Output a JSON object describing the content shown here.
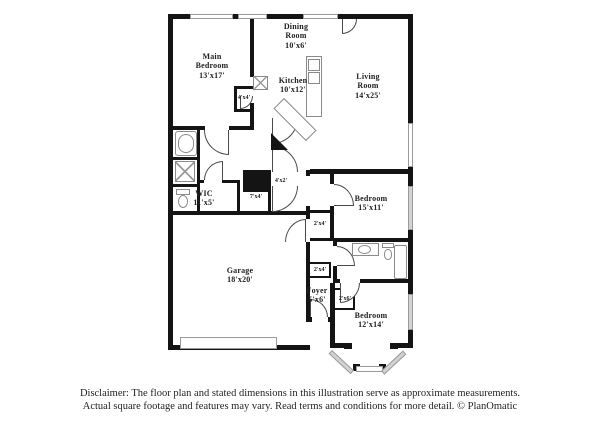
{
  "colors": {
    "wall": "#141414",
    "window_gray": "#d2d2d2",
    "fixture_line": "#8a8a8a",
    "text": "#222222",
    "background": "#ffffff"
  },
  "rooms": {
    "main_bedroom": {
      "label": "Main\nBedroom\n13'x17'"
    },
    "dining_room": {
      "label": "Dining\nRoom\n10'x6'"
    },
    "kitchen": {
      "label": "Kitchen\n10'x12'"
    },
    "living_room": {
      "label": "Living\nRoom\n14'x25'"
    },
    "wic": {
      "label": "WIC\n11'x5'"
    },
    "bedroom_15x11": {
      "label": "Bedroom\n15'x11'"
    },
    "garage": {
      "label": "Garage\n18'x20'"
    },
    "foyer": {
      "label": "Foyer\n5'x6'"
    },
    "bedroom_12x14": {
      "label": "Bedroom\n12'x14'"
    }
  },
  "closets": {
    "hall_closet_a": "4'x4'",
    "utility_nook": "4'x2'",
    "hall_closet_b": "7'x4'",
    "bedroom2_closet": "2'x4'",
    "corridor_closet": "2'x4'",
    "bedroom3_closet": "2'x6'"
  },
  "disclaimer": {
    "line1": "Disclaimer: The floor plan and stated dimensions in this illustration serve as approximate measurements.",
    "line2": "Actual square footage and features may vary. Read terms and conditions for more detail. © PlanOmatic"
  }
}
